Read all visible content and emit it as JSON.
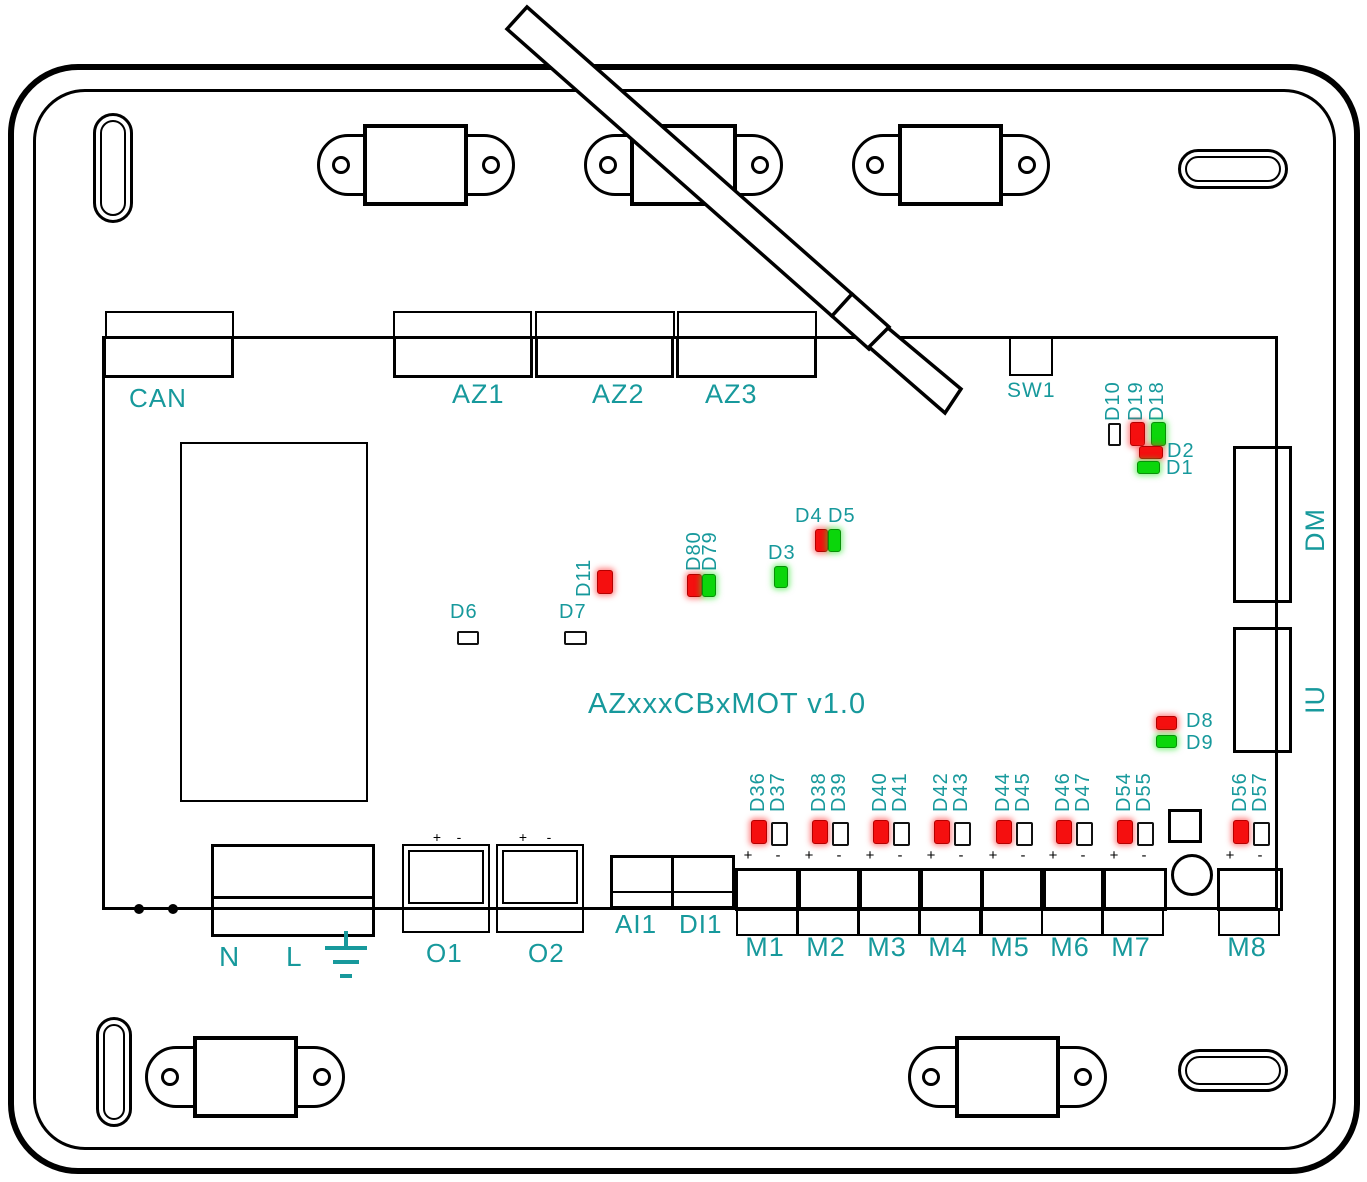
{
  "title": "AZxxxCBxMOT v1.0",
  "colors": {
    "teal": "#17999c",
    "led_red": "#f50f0f",
    "led_green": "#0bd60b"
  },
  "connectors": {
    "can": "CAN",
    "az1": "AZ1",
    "az2": "AZ2",
    "az3": "AZ3",
    "sw1": "SW1",
    "dm": "DM",
    "iu": "IU",
    "ai1": "AI1",
    "di1": "DI1",
    "n": "N",
    "l": "L",
    "o1": "O1",
    "o2": "O2",
    "m": [
      "M1",
      "M2",
      "M3",
      "M4",
      "M5",
      "M6",
      "M7",
      "M8"
    ]
  },
  "marks": {
    "plus": "+",
    "minus": "-"
  },
  "leds": {
    "d10": "D10",
    "d19": "D19",
    "d18": "D18",
    "d2": "D2",
    "d1": "D1",
    "d11": "D11",
    "d80": "D80",
    "d79": "D79",
    "d3": "D3",
    "d4": "D4",
    "d5": "D5",
    "d6": "D6",
    "d7": "D7",
    "d8": "D8",
    "d9": "D9",
    "m_red": [
      "D36",
      "D38",
      "D40",
      "D42",
      "D44",
      "D46",
      "D54",
      "D56"
    ],
    "m_off": [
      "D37",
      "D39",
      "D41",
      "D43",
      "D45",
      "D47",
      "D55",
      "D57"
    ]
  }
}
